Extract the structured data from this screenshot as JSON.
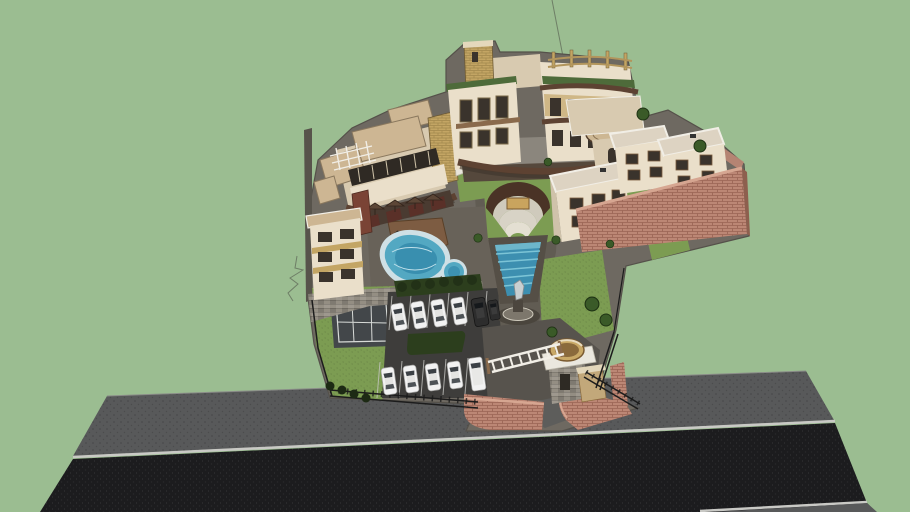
{
  "meta": {
    "description": "Aerial 3D model view of a walled resort hotel complex on a plain green background with a street along the bottom"
  },
  "colors": {
    "background": "#9bbd91",
    "road_sidewalk": "#58595a",
    "road_asphalt": "#1c1c1e",
    "road_curb": "#c9c9c5",
    "paving": "#6e6961",
    "paving_light": "#8b867d",
    "paving_dark": "#615c53",
    "parking_asphalt": "#3e3d3b",
    "driveway": "#57534d",
    "grass": "#7c9c52",
    "hedge": "#2c3e1d",
    "tree_green": "#3a5a28",
    "shrub_dark": "#1d2a14",
    "pool_border": "#cfe0e5",
    "pool_water": "#53a8c2",
    "pool_water_deep": "#2f84a6",
    "cascade_water": "#3d8fb0",
    "cascade_step": "#7cc4d6",
    "deck_wood": "#7d5c42",
    "building_cream": "#eadfca",
    "building_cream_shade": "#d8cab0",
    "building_tan": "#c3a564",
    "roof_tan": "#cdb693",
    "roof_brown": "#5d4232",
    "green_roof": "#4e6b3a",
    "window_dark": "#3a332c",
    "window_red": "#5a3028",
    "white_trim": "#f1eee6",
    "brick_wall": "#bc8775",
    "brick_wall_light": "#d6a691",
    "stone_wall": "#948e83",
    "fence_dark": "#1c1c1c",
    "car_white": "#f2f2f2",
    "car_glass": "#3c4146",
    "car_dark": "#2d2d2d",
    "statue": "#c9cfd1",
    "court_surface": "#43474a",
    "court_line": "#d8dbd8",
    "amphi_wall": "#4a3326",
    "amphi_steps": "#d8d3c6",
    "amphi_stage": "#c9a45e",
    "stray_line": "#6e7e66"
  },
  "scene": {
    "description": "Aerial 3D model view of a walled resort hotel complex on a plain green background with a street along the bottom",
    "features": [
      "main hotel building with brick tower and curved brown awnings",
      "stepped left wing with rooftop pergola and terrace umbrellas",
      "left tower block on a stone base wall",
      "three two-story villas behind a salmon brick perimeter wall",
      "semicircular amphitheater in a lawn",
      "stepped cascade water feature ending at a statue",
      "freeform swimming pool with attached round spa",
      "wooden pool deck with loungers",
      "tennis court",
      "two parking rows with white cars",
      "entrance gate with white trellis, round planter bowl and stone gatehouse",
      "black iron fences and salmon brick entrance walls",
      "street with gray sidewalk, white curbs and dark asphalt"
    ],
    "vehicles": {
      "upper_row_white_cars": 4,
      "upper_row_dark_vehicles": 2,
      "lower_row_white_cars": 4,
      "lower_row_white_vans": 1
    },
    "counts": {
      "terrace_umbrellas": 4,
      "pool_loungers": 3,
      "dark_shrubs_row": 4,
      "trees": 9
    }
  }
}
